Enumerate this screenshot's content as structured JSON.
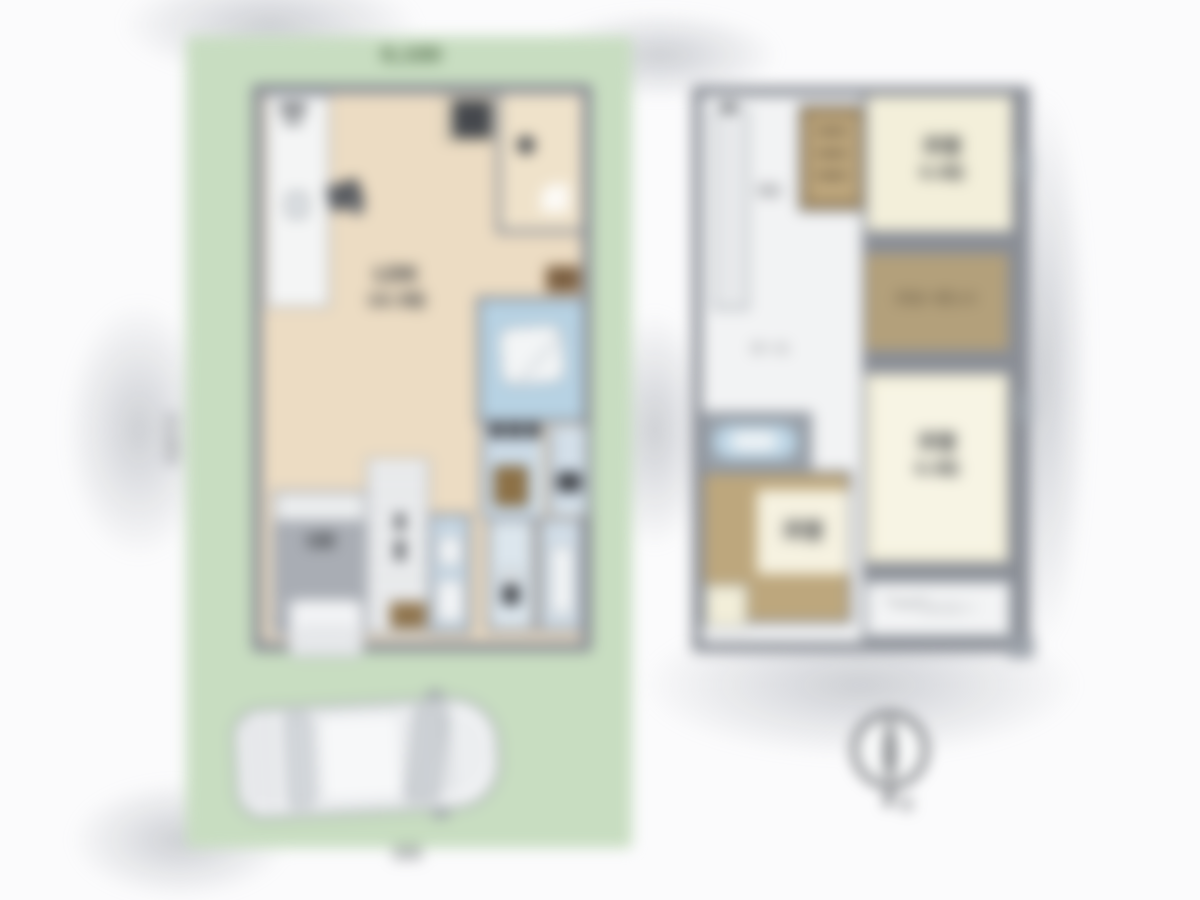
{
  "site": {
    "top_dimension": "9,100",
    "side_dimension": "13,650",
    "road_label": "道路"
  },
  "floor1": {
    "ldk_name": "LDK",
    "ldk_size": "16.5帖",
    "genkan": "玄関"
  },
  "floor2": {
    "stairs": "階段",
    "hall": "ホール",
    "closet": "クローゼット",
    "bedroom1_name": "洋室",
    "bedroom1_size": "6.0帖",
    "bedroom2_name": "洋室",
    "bedroom2_size": "6.0帖",
    "room3_name": "洋室",
    "balcony": "バルコニー"
  },
  "compass": {
    "mark": "N"
  },
  "colors": {
    "lot-green": "#c8ddc1",
    "wall-gray": "#8a8e96",
    "floor-beige": "#ecdcc3",
    "room-cream": "#f3efda",
    "closet-tan": "#b3a07b",
    "bath-blue": "#b7d2e3",
    "pale-blue": "#ccdbe7",
    "label-dark": "#3a3d41",
    "dim-green": "#46613f"
  }
}
